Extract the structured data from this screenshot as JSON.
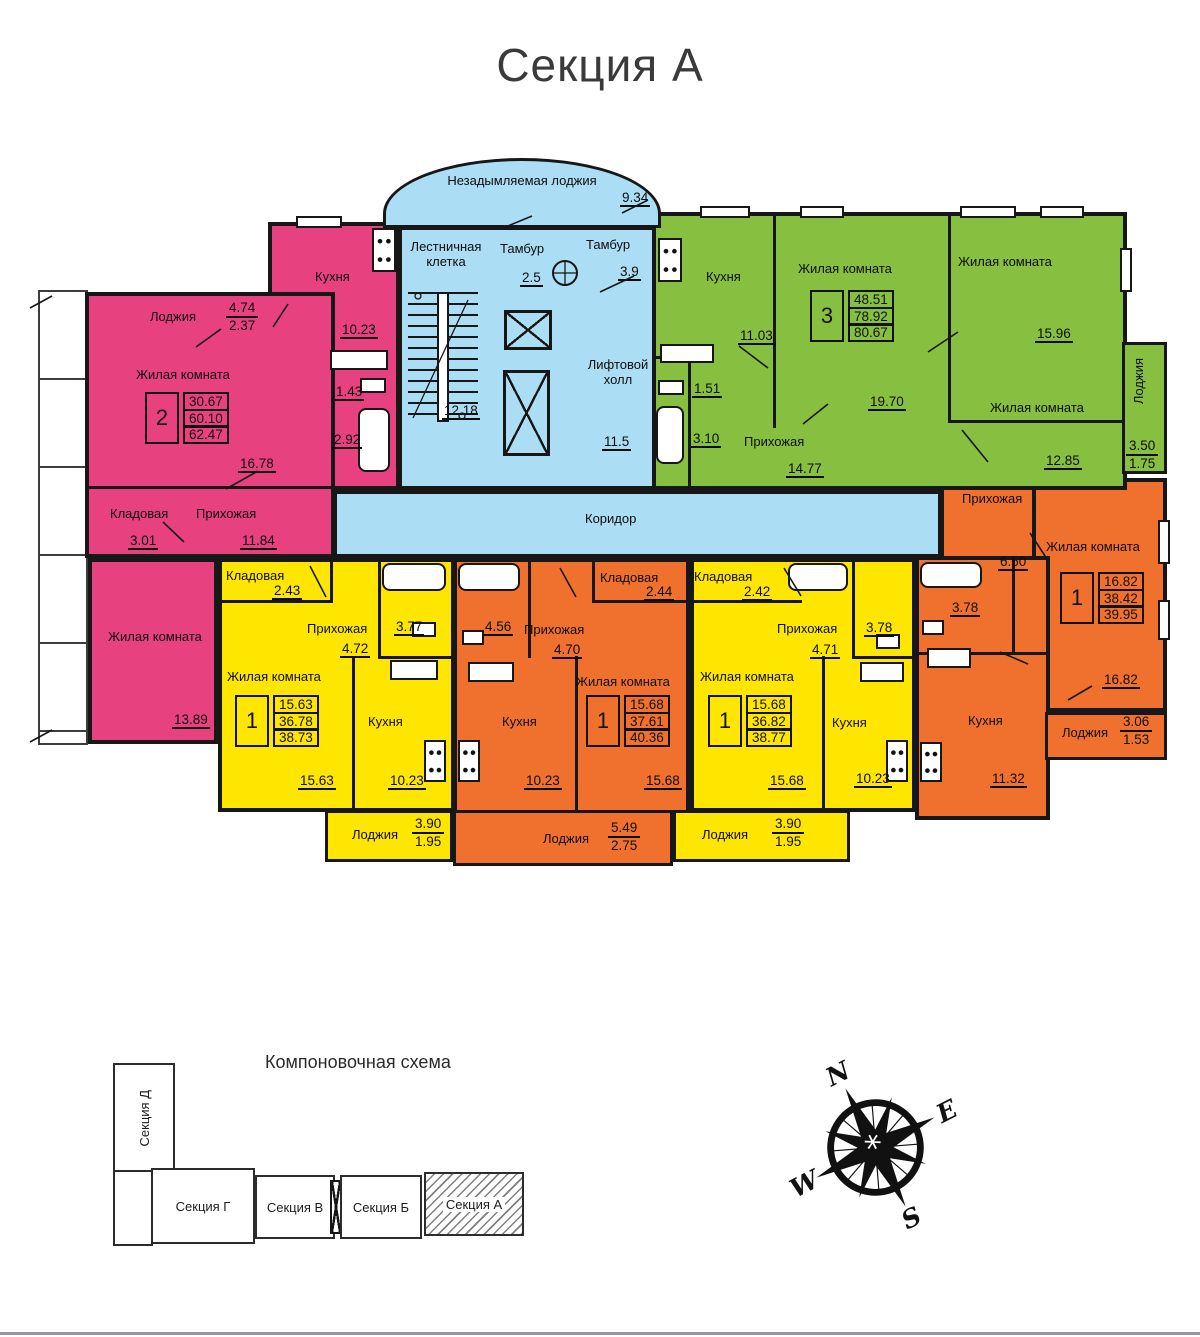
{
  "title": "Секция А",
  "colors": {
    "pink": "#e8417f",
    "green": "#87bf41",
    "yellow": "#ffe600",
    "orange": "#f0712e",
    "blue": "#abdef5"
  },
  "core": {
    "smoke_free_loggia": {
      "label": "Незадымляемая лоджия",
      "area": "9.34"
    },
    "stairwell": {
      "label": "Лестничная клетка",
      "area": "12.18"
    },
    "tambur1": {
      "label": "Тамбур",
      "area": "2.5"
    },
    "tambur2": {
      "label": "Тамбур",
      "area": "3.9"
    },
    "lift_hall": {
      "label": "Лифтовой холл",
      "area": "11.5"
    },
    "corridor": {
      "label": "Коридор"
    }
  },
  "apartments": {
    "pink": {
      "type": "2",
      "totals": [
        "30.67",
        "60.10",
        "62.47"
      ],
      "kitchen": {
        "label": "Кухня",
        "area": "10.23"
      },
      "loggia": {
        "label": "Лоджия",
        "num": "4.74",
        "den": "2.37"
      },
      "living1": {
        "label": "Жилая комната",
        "area": "16.78"
      },
      "wc": {
        "area": "1.43"
      },
      "bath": {
        "area": "2.92"
      },
      "storage": {
        "label": "Кладовая",
        "area": "3.01"
      },
      "hall": {
        "label": "Прихожая",
        "area": "11.84"
      },
      "living2": {
        "label": "Жилая комната",
        "area": "13.89"
      }
    },
    "green": {
      "type": "3",
      "totals": [
        "48.51",
        "78.92",
        "80.67"
      ],
      "kitchen": {
        "label": "Кухня",
        "area": "11.03"
      },
      "living1": {
        "label": "Жилая комната",
        "area": "19.70"
      },
      "living2": {
        "label": "Жилая комната",
        "area": "15.96"
      },
      "living3": {
        "label": "Жилая комната",
        "area": "12.85"
      },
      "wc": {
        "area": "1.51"
      },
      "bath": {
        "area": "3.10"
      },
      "hall": {
        "label": "Прихожая",
        "area": "14.77"
      },
      "loggia": {
        "label": "Лоджия",
        "num": "3.50",
        "den": "1.75"
      }
    },
    "orange_right": {
      "type": "1",
      "totals": [
        "16.82",
        "38.42",
        "39.95"
      ],
      "hall": {
        "label": "Прихожая",
        "area": "6.50"
      },
      "living": {
        "label": "Жилая комната",
        "area": "16.82"
      },
      "bath": {
        "area": "3.78"
      },
      "kitchen": {
        "label": "Кухня",
        "area": "11.32"
      },
      "loggia": {
        "label": "Лоджия",
        "num": "3.06",
        "den": "1.53"
      }
    },
    "yellow_left": {
      "type": "1",
      "totals": [
        "15.63",
        "36.78",
        "38.73"
      ],
      "storage": {
        "label": "Кладовая",
        "area": "2.43"
      },
      "hall": {
        "label": "Прихожая",
        "area": "4.72"
      },
      "bath": {
        "area": "3.77"
      },
      "living": {
        "label": "Жилая комната",
        "area": "15.63"
      },
      "kitchen": {
        "label": "Кухня",
        "area": "10.23"
      },
      "loggia": {
        "label": "Лоджия",
        "num": "3.90",
        "den": "1.95"
      }
    },
    "orange_mid": {
      "type": "1",
      "totals": [
        "15.68",
        "37.61",
        "40.36"
      ],
      "bath": {
        "area": "4.56"
      },
      "hall": {
        "label": "Прихожая",
        "area": "4.70"
      },
      "storage": {
        "label": "Кладовая",
        "area": "2.44"
      },
      "living": {
        "label": "Жилая комната",
        "area": "15.68"
      },
      "kitchen": {
        "label": "Кухня",
        "area": "10.23"
      },
      "loggia": {
        "label": "Лоджия",
        "num": "5.49",
        "den": "2.75"
      }
    },
    "yellow_right": {
      "type": "1",
      "totals": [
        "15.68",
        "36.82",
        "38.77"
      ],
      "storage": {
        "label": "Кладовая",
        "area": "2.42"
      },
      "hall": {
        "label": "Прихожая",
        "area": "4.71"
      },
      "bath": {
        "area": "3.78"
      },
      "living": {
        "label": "Жилая комната",
        "area": "15.68"
      },
      "kitchen": {
        "label": "Кухня",
        "area": "10.23"
      },
      "loggia": {
        "label": "Лоджия",
        "num": "3.90",
        "den": "1.95"
      }
    }
  },
  "scheme": {
    "title": "Компоновочная схема",
    "sections": [
      "Секция Д",
      "Секция Г",
      "Секция В",
      "Секция Б",
      "Секция А"
    ]
  },
  "compass": {
    "n": "N",
    "e": "E",
    "s": "S",
    "w": "W"
  }
}
